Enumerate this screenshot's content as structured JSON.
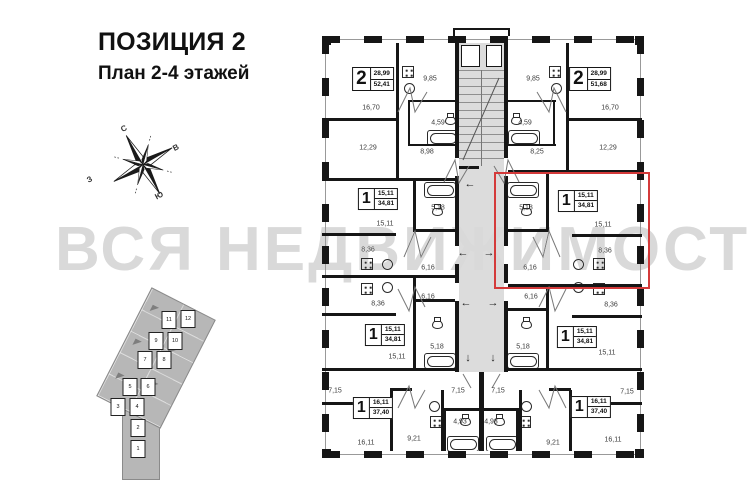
{
  "header": {
    "title": "ПОЗИЦИЯ 2",
    "subtitle": "План 2-4 этажей"
  },
  "watermark_text": "ВСЯ НЕДВИЖИМОСТЬ",
  "compass": {
    "north": "С",
    "east": "В",
    "south": "Ю",
    "west": "З"
  },
  "colors": {
    "wall": "#161616",
    "corridor_fill": "#dcdcdc",
    "highlight_red": "#d43a3a",
    "watermark_gray": "#d9d9d9",
    "siteplan_gray": "#b7b7b7"
  },
  "floor_plan": {
    "highlight_box": {
      "x": 494,
      "y": 172,
      "width": 152,
      "height": 113
    },
    "apartments": [
      {
        "id": "apt-top-left",
        "rooms_count": "2",
        "area_living": "28,99",
        "area_total": "52,41",
        "x": 373,
        "y": 79,
        "highlighted": false
      },
      {
        "id": "apt-top-right",
        "rooms_count": "2",
        "area_living": "28,99",
        "area_total": "51,68",
        "x": 590,
        "y": 79,
        "highlighted": false
      },
      {
        "id": "apt-mid-left",
        "rooms_count": "1",
        "area_living": "15,11",
        "area_total": "34,81",
        "x": 378,
        "y": 199,
        "highlighted": false
      },
      {
        "id": "apt-mid-right",
        "rooms_count": "1",
        "area_living": "15,11",
        "area_total": "34,81",
        "x": 578,
        "y": 201,
        "highlighted": true
      },
      {
        "id": "apt-lowmid-left",
        "rooms_count": "1",
        "area_living": "15,11",
        "area_total": "34,81",
        "x": 385,
        "y": 335,
        "highlighted": false
      },
      {
        "id": "apt-lowmid-right",
        "rooms_count": "1",
        "area_living": "15,11",
        "area_total": "34,81",
        "x": 577,
        "y": 337,
        "highlighted": false
      },
      {
        "id": "apt-bottom-left",
        "rooms_count": "1",
        "area_living": "16,11",
        "area_total": "37,40",
        "x": 373,
        "y": 408,
        "highlighted": false
      },
      {
        "id": "apt-bottom-right",
        "rooms_count": "1",
        "area_living": "16,11",
        "area_total": "37,40",
        "x": 591,
        "y": 407,
        "highlighted": false
      }
    ],
    "room_labels": [
      {
        "room": "kitchen",
        "area": "9,85",
        "x": 430,
        "y": 79
      },
      {
        "room": "living",
        "area": "16,70",
        "x": 371,
        "y": 108
      },
      {
        "room": "bath",
        "area": "4,59",
        "x": 438,
        "y": 123
      },
      {
        "room": "bedroom",
        "area": "12,29",
        "x": 368,
        "y": 148
      },
      {
        "room": "hall",
        "area": "8,98",
        "x": 427,
        "y": 152
      },
      {
        "room": "kitchen",
        "area": "9,85",
        "x": 533,
        "y": 79
      },
      {
        "room": "living",
        "area": "16,70",
        "x": 610,
        "y": 108
      },
      {
        "room": "bath",
        "area": "4,59",
        "x": 525,
        "y": 123
      },
      {
        "room": "bedroom",
        "area": "12,29",
        "x": 608,
        "y": 148
      },
      {
        "room": "hall",
        "area": "8,25",
        "x": 537,
        "y": 152
      },
      {
        "room": "bath",
        "area": "5,18",
        "x": 438,
        "y": 208
      },
      {
        "room": "living",
        "area": "15,11",
        "x": 385,
        "y": 224
      },
      {
        "room": "kitchen",
        "area": "8,36",
        "x": 368,
        "y": 250
      },
      {
        "room": "hall",
        "area": "6,16",
        "x": 428,
        "y": 268
      },
      {
        "room": "bath",
        "area": "5,18",
        "x": 526,
        "y": 208
      },
      {
        "room": "living",
        "area": "15,11",
        "x": 603,
        "y": 225
      },
      {
        "room": "kitchen",
        "area": "8,36",
        "x": 605,
        "y": 251
      },
      {
        "room": "hall",
        "area": "6,16",
        "x": 530,
        "y": 268
      },
      {
        "room": "hall",
        "area": "6,16",
        "x": 428,
        "y": 297
      },
      {
        "room": "kitchen",
        "area": "8,36",
        "x": 378,
        "y": 304
      },
      {
        "room": "bath",
        "area": "5,18",
        "x": 437,
        "y": 347
      },
      {
        "room": "living",
        "area": "15,11",
        "x": 397,
        "y": 357
      },
      {
        "room": "hall",
        "area": "6,16",
        "x": 531,
        "y": 297
      },
      {
        "room": "kitchen",
        "area": "8,36",
        "x": 611,
        "y": 305
      },
      {
        "room": "bath",
        "area": "5,18",
        "x": 523,
        "y": 347
      },
      {
        "room": "living",
        "area": "15,11",
        "x": 607,
        "y": 353
      },
      {
        "room": "hall",
        "area": "7,15",
        "x": 335,
        "y": 391
      },
      {
        "room": "hall",
        "area": "7,15",
        "x": 458,
        "y": 391
      },
      {
        "room": "bath",
        "area": "4,93",
        "x": 460,
        "y": 422
      },
      {
        "room": "kitchen",
        "area": "9,21",
        "x": 414,
        "y": 439
      },
      {
        "room": "living",
        "area": "16,11",
        "x": 366,
        "y": 443
      },
      {
        "room": "hall",
        "area": "7,15",
        "x": 498,
        "y": 391
      },
      {
        "room": "hall",
        "area": "7,15",
        "x": 627,
        "y": 392
      },
      {
        "room": "bath",
        "area": "4,93",
        "x": 491,
        "y": 422
      },
      {
        "room": "kitchen",
        "area": "9,21",
        "x": 553,
        "y": 443
      },
      {
        "room": "living",
        "area": "16,11",
        "x": 613,
        "y": 440
      }
    ],
    "corridor_arrows": [
      {
        "dir": "left",
        "glyph": "←",
        "x": 470,
        "y": 184
      },
      {
        "dir": "left",
        "glyph": "←",
        "x": 463,
        "y": 253
      },
      {
        "dir": "right",
        "glyph": "→",
        "x": 489,
        "y": 253
      },
      {
        "dir": "left",
        "glyph": "←",
        "x": 466,
        "y": 303
      },
      {
        "dir": "right",
        "glyph": "→",
        "x": 493,
        "y": 303
      },
      {
        "dir": "down",
        "glyph": "↓",
        "x": 468,
        "y": 358
      },
      {
        "dir": "down",
        "glyph": "↓",
        "x": 493,
        "y": 358
      }
    ]
  },
  "site_plan": {
    "blocks": [
      {
        "label": "11",
        "x": 169,
        "y": 320
      },
      {
        "label": "12",
        "x": 188,
        "y": 319
      },
      {
        "label": "9",
        "x": 156,
        "y": 341
      },
      {
        "label": "10",
        "x": 175,
        "y": 341
      },
      {
        "label": "7",
        "x": 145,
        "y": 360
      },
      {
        "label": "8",
        "x": 164,
        "y": 360
      },
      {
        "label": "5",
        "x": 130,
        "y": 387
      },
      {
        "label": "6",
        "x": 148,
        "y": 387
      },
      {
        "label": "3",
        "x": 118,
        "y": 407
      },
      {
        "label": "4",
        "x": 137,
        "y": 407
      },
      {
        "label": "2",
        "x": 138,
        "y": 428
      },
      {
        "label": "1",
        "x": 138,
        "y": 449
      }
    ]
  }
}
